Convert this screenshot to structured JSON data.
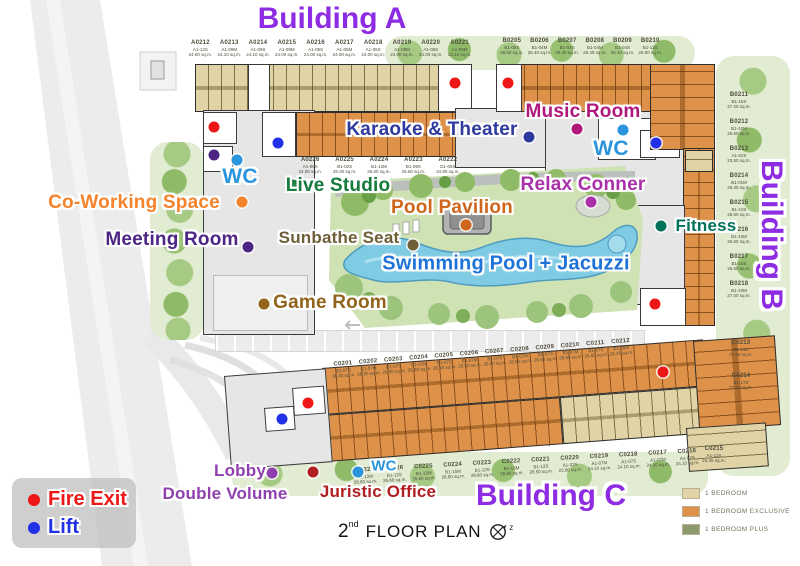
{
  "colors": {
    "title_purple": "#8d2ce2",
    "fire_red": "#ee1717",
    "lift_blue": "#2230e8",
    "wc_blue": "#2a95dc",
    "music": "#b0187c",
    "karaoke": "#2f3a9e",
    "live_studio": "#157a3c",
    "coworking": "#f5832c",
    "relax": "#aa30aa",
    "pavilion": "#d0661c",
    "meeting": "#4d2585",
    "sunbathe": "#6e5f39",
    "fitness": "#00725a",
    "pool": "#1e73d8",
    "game": "#92641c",
    "lobby": "#8f3fae",
    "juristic": "#b02020",
    "unit_tan": "#e0d4a6",
    "unit_orange": "#de9148",
    "unit_olive": "#8c9a6e"
  },
  "titles": {
    "building_a": "Building A",
    "building_b": "Building B",
    "building_c": "Building C"
  },
  "legend": {
    "fire_exit": "Fire Exit",
    "lift": "Lift"
  },
  "unit_legend": {
    "bedroom": "1 BEDROOM",
    "exclusive": "1 BEDROOM EXCLUSIVE",
    "plus": "1 BEDROOM PLUS"
  },
  "footer": {
    "floor_number": "2",
    "floor_ordinal": "nd",
    "floor_label": "FLOOR PLAN",
    "compass": "z"
  },
  "amenities": {
    "music_room": {
      "label": "Music Room"
    },
    "karaoke_theater": {
      "label": "Karaoke & Theater"
    },
    "wc": {
      "label": "WC"
    },
    "live_studio": {
      "label": "Live Studio"
    },
    "co_working": {
      "label": "Co-Working Space"
    },
    "relax_conner": {
      "label": "Relax Conner"
    },
    "pool_pavilion": {
      "label": "Pool Pavilion"
    },
    "meeting_room": {
      "label": "Meeting Room"
    },
    "sunbathe_seat": {
      "label": "Sunbathe Seat"
    },
    "fitness": {
      "label": "Fitness"
    },
    "swimming_pool": {
      "label": "Swimming Pool + Jacuzzi"
    },
    "game_room": {
      "label": "Game Room"
    },
    "lobby": {
      "label": "Lobby"
    },
    "double_volume": {
      "label": "Double Volume"
    },
    "juristic_office": {
      "label": "Juristic Office"
    }
  },
  "units": {
    "a_top": [
      {
        "no": "A0212",
        "type": "A1-12S",
        "area": "24.60 sq.m."
      },
      {
        "no": "A0213",
        "type": "A1-09M",
        "area": "24.10 sq.m."
      },
      {
        "no": "A0214",
        "type": "A1-09S",
        "area": "24.10 sq.m."
      },
      {
        "no": "A0215",
        "type": "A1-09M",
        "area": "24.00 sq.m."
      },
      {
        "no": "A0216",
        "type": "A1-05S",
        "area": "24.00 sq.m."
      },
      {
        "no": "A0217",
        "type": "A1-05M",
        "area": "24.00 sq.m."
      },
      {
        "no": "A0218",
        "type": "A1-05S",
        "area": "24.00 sq.m."
      },
      {
        "no": "A0219",
        "type": "A1-05M",
        "area": "24.00 sq.m."
      },
      {
        "no": "A0220",
        "type": "A1-05S",
        "area": "24.00 sq.m."
      },
      {
        "no": "A0221",
        "type": "A1-09M",
        "area": "24.10 sq.m."
      }
    ],
    "a_row2": [
      {
        "no": "A0226",
        "type": "A1-06S",
        "area": "24.00 sq.m."
      },
      {
        "no": "A0225",
        "type": "B1-02S",
        "area": "26.30 sq.m."
      },
      {
        "no": "A0224",
        "type": "B1-12M",
        "area": "26.60 sq.m."
      },
      {
        "no": "A0223",
        "type": "B1-09S",
        "area": "26.50 sq.m."
      },
      {
        "no": "A0222",
        "type": "D1-05S",
        "area": "34.90 sq.m."
      }
    ],
    "b_top": [
      {
        "no": "B0205",
        "type": "B1-06S",
        "area": "26.50 sq.m."
      },
      {
        "no": "B0206",
        "type": "B1-04M",
        "area": "26.40 sq.m."
      },
      {
        "no": "B0207",
        "type": "B1-04S",
        "area": "26.40 sq.m."
      },
      {
        "no": "B0208",
        "type": "B1-04M",
        "area": "26.40 sq.m."
      },
      {
        "no": "B0209",
        "type": "B1-04S",
        "area": "26.40 sq.m."
      },
      {
        "no": "B0210",
        "type": "B1-13S",
        "area": "26.80 sq.m."
      }
    ],
    "b_right": [
      {
        "no": "B0211",
        "type": "B1-15S",
        "area": "27.20 sq.m."
      },
      {
        "no": "B0212",
        "type": "B1-10M",
        "area": "26.50 sq.m."
      },
      {
        "no": "B0213",
        "type": "A1-02S",
        "area": "23.80 sq.m."
      },
      {
        "no": "B0214",
        "type": "B1-01M",
        "area": "26.30 sq.m."
      },
      {
        "no": "B0215",
        "type": "B1-10S",
        "area": "26.50 sq.m."
      },
      {
        "no": "B0216",
        "type": "B1-10M",
        "area": "26.60 sq.m."
      },
      {
        "no": "B0217",
        "type": "B1-10S",
        "area": "26.60 sq.m."
      },
      {
        "no": "B0218",
        "type": "B1-10M",
        "area": "27.00 sq.m."
      }
    ],
    "c_top": [
      {
        "no": "C0201",
        "type": "B1-07S",
        "area": "26.40 sq.m."
      },
      {
        "no": "C0202",
        "type": "B1-07M",
        "area": "26.50 sq.m."
      },
      {
        "no": "C0203",
        "type": "B1-07S",
        "area": "26.50 sq.m."
      },
      {
        "no": "C0204",
        "type": "B1-07M",
        "area": "26.50 sq.m."
      },
      {
        "no": "C0205",
        "type": "B1-07S",
        "area": "26.50 sq.m."
      },
      {
        "no": "C0206",
        "type": "B1-07M",
        "area": "26.50 sq.m."
      },
      {
        "no": "C0207",
        "type": "B1-07S",
        "area": "26.50 sq.m."
      },
      {
        "no": "C0208",
        "type": "B1-07M",
        "area": "26.50 sq.m."
      },
      {
        "no": "C0209",
        "type": "B1-07S",
        "area": "26.50 sq.m."
      },
      {
        "no": "C0210",
        "type": "B1-07M",
        "area": "26.50 sq.m."
      },
      {
        "no": "C0211",
        "type": "B1-07S",
        "area": "26.50 sq.m."
      },
      {
        "no": "C0212",
        "type": "B1-20M",
        "area": "26.40 sq.m."
      }
    ],
    "c_bottom": [
      {
        "no": "C0227",
        "type": "B1-12M",
        "area": "26.60 sq.m."
      },
      {
        "no": "C0226",
        "type": "B1-12S",
        "area": "26.60 sq.m."
      },
      {
        "no": "C0225",
        "type": "B1-12M",
        "area": "26.60 sq.m."
      },
      {
        "no": "C0224",
        "type": "B1-15M",
        "area": "26.60 sq.m."
      },
      {
        "no": "C0223",
        "type": "B1-12S",
        "area": "26.80 sq.m."
      },
      {
        "no": "C0222",
        "type": "B1-15M",
        "area": "26.80 sq.m."
      },
      {
        "no": "C0221",
        "type": "B1-12S",
        "area": "26.50 sq.m."
      },
      {
        "no": "C0220",
        "type": "A1-02S",
        "area": "23.80 sq.m."
      },
      {
        "no": "C0219",
        "type": "A1-07M",
        "area": "24.10 sq.m."
      },
      {
        "no": "C0218",
        "type": "A1-07S",
        "area": "24.10 sq.m."
      },
      {
        "no": "C0217",
        "type": "A1-07M",
        "area": "24.10 sq.m."
      },
      {
        "no": "C0216",
        "type": "A1-07S",
        "area": "24.10 sq.m."
      }
    ],
    "c_right": [
      {
        "no": "C0213",
        "type": "B1-14S",
        "area": "27.00 sq.m."
      },
      {
        "no": "C0214",
        "type": "B1-17S",
        "area": "27.30 sq.m."
      }
    ],
    "c_215": [
      {
        "no": "C0215",
        "type": "A1-11S",
        "area": "24.40 sq.m."
      }
    ]
  }
}
